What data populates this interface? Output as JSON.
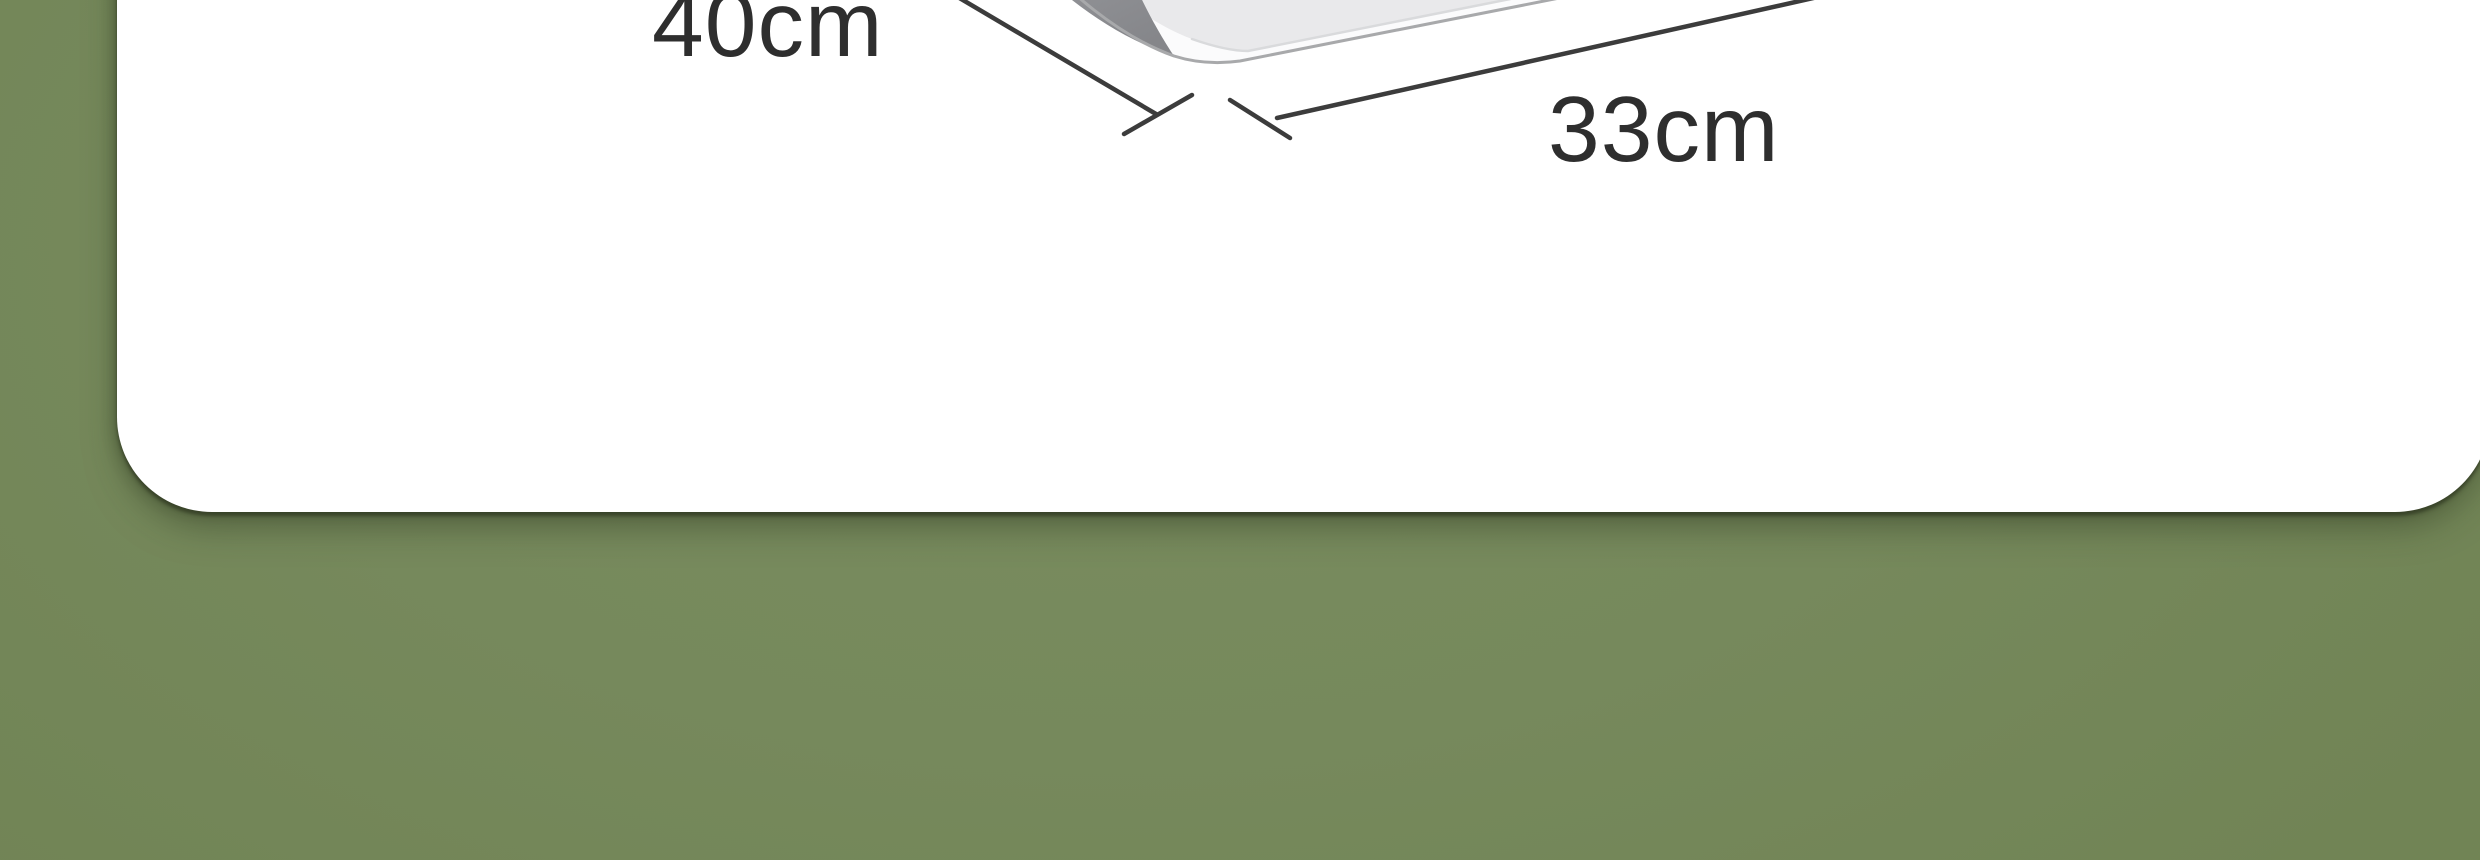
{
  "scene": {
    "background_color": "#76895C",
    "card_color": "#FFFFFF"
  },
  "dimension_diagram": {
    "dimensions": [
      {
        "side": "left-depth",
        "label": "40cm"
      },
      {
        "side": "front-width",
        "label": "33cm"
      }
    ],
    "annotation_color": "#3C3C3C",
    "text_color": "#2E2E2E",
    "product": {
      "body_color": "#E9E9EB",
      "rim_color": "#FBFBFC",
      "outline_color": "#A8A9AB",
      "rim_separator_color": "#D9DADC",
      "side_shadow_dark": "#85868A",
      "side_shadow_light": "#A7A8AB"
    }
  }
}
